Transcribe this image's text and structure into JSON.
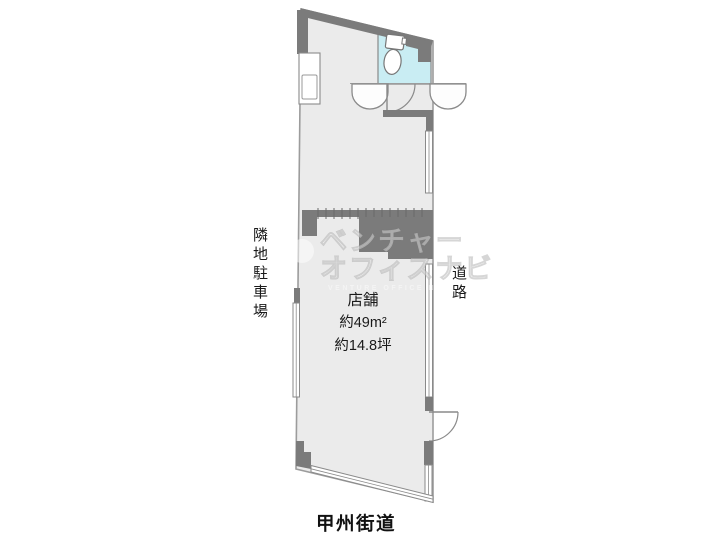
{
  "plan": {
    "room": {
      "name": "店舗",
      "area_m2": "約49m²",
      "area_tsubo": "約14.8坪"
    },
    "labels": {
      "left_vertical": "隣地駐車場",
      "right_vertical": "道路",
      "bottom_road": "甲州街道"
    },
    "watermark": {
      "line1": "ベンチャー",
      "line2": "オフィスナビ",
      "sub": "VENTURE OFFICE NAVI"
    },
    "colors": {
      "wall": "#7b7b7b",
      "floor": "#ebebeb",
      "toilet_floor": "#c9edf3",
      "outline": "#8f8f8f",
      "background": "#ffffff"
    }
  }
}
